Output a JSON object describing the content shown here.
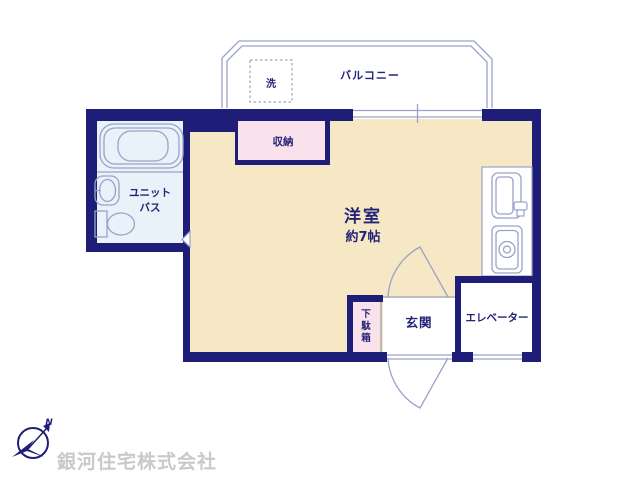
{
  "colors": {
    "wall": "#1e1e78",
    "room": "#f6e8c5",
    "closet": "#f9e2ec",
    "bath": "#e9f1f9",
    "line": "#9aa2c8",
    "text": "#232378",
    "watermark": "#c9c9cd"
  },
  "rooms": {
    "balcony": {
      "label": "バルコニー"
    },
    "washer": {
      "label": "洗"
    },
    "bath": {
      "label_line1": "ユニット",
      "label_line2": "バス"
    },
    "closet": {
      "label": "収納"
    },
    "main_room": {
      "label": "洋室",
      "size": "約7帖"
    },
    "entrance": {
      "label": "玄関"
    },
    "shoe_cabinet": {
      "chars": [
        "下",
        "駄",
        "箱"
      ]
    },
    "elevator": {
      "label": "エレベーター"
    }
  },
  "compass": {
    "north_label": "N"
  },
  "company": {
    "name": "銀河住宅株式会社"
  }
}
